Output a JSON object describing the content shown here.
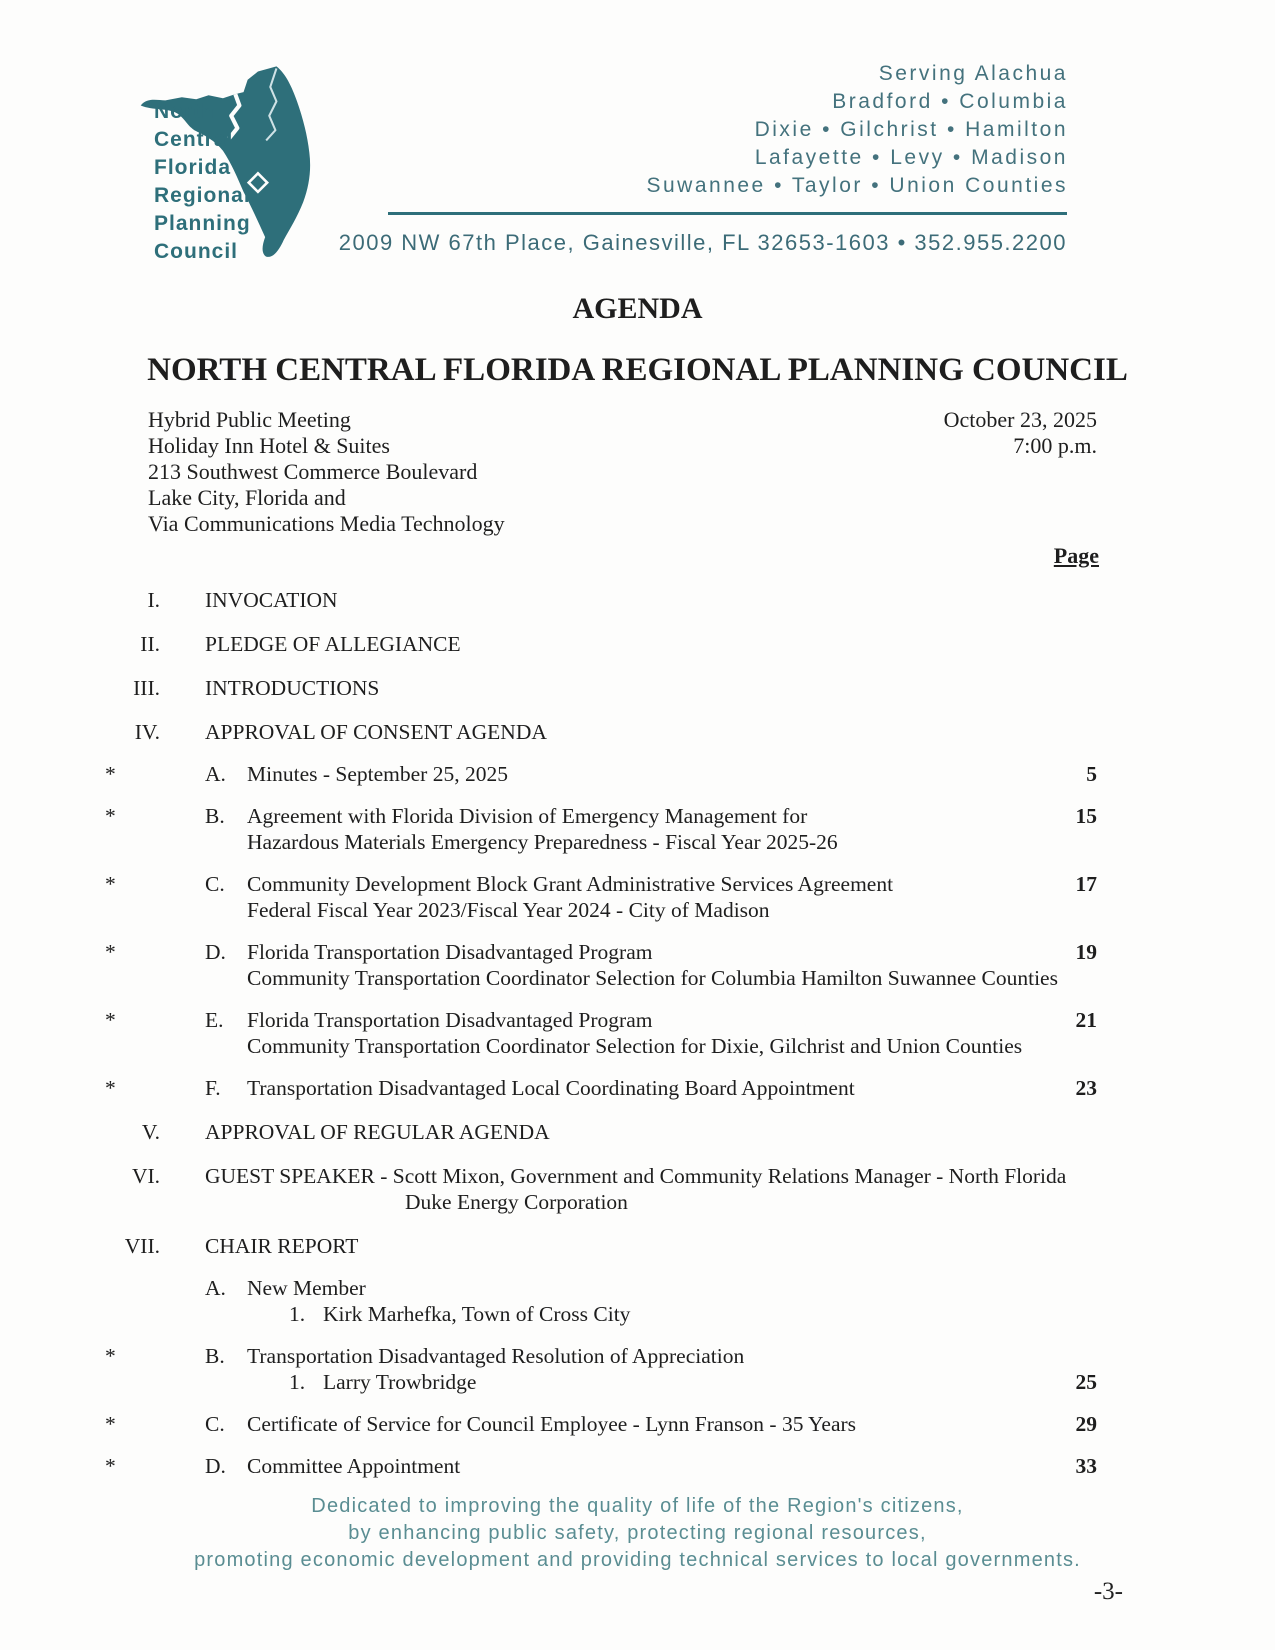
{
  "header": {
    "logo_lines": [
      "North",
      "Central",
      "Florida",
      "Regional",
      "Planning",
      "Council"
    ],
    "serving_lines": [
      "Serving Alachua",
      "Bradford • Columbia",
      "Dixie • Gilchrist • Hamilton",
      "Lafayette • Levy • Madison",
      "Suwannee • Taylor • Union Counties"
    ],
    "address": "2009 NW 67th Place, Gainesville, FL 32653-1603 • 352.955.2200"
  },
  "title": {
    "agenda": "AGENDA",
    "council": "NORTH CENTRAL FLORIDA REGIONAL PLANNING COUNCIL"
  },
  "meeting": {
    "location_lines": [
      "Hybrid Public Meeting",
      "Holiday Inn Hotel & Suites",
      "213 Southwest Commerce Boulevard",
      "Lake City, Florida and",
      "Via Communications Media Technology"
    ],
    "date": "October 23, 2025",
    "time": "7:00 p.m."
  },
  "page_label": "Page",
  "agenda": {
    "items": [
      {
        "num": "I.",
        "title": "INVOCATION"
      },
      {
        "num": "II.",
        "title": "PLEDGE OF ALLEGIANCE"
      },
      {
        "num": "III.",
        "title": "INTRODUCTIONS"
      },
      {
        "num": "IV.",
        "title": "APPROVAL OF CONSENT AGENDA"
      },
      {
        "num": "V.",
        "title": "APPROVAL OF REGULAR AGENDA"
      },
      {
        "num": "VI.",
        "title": "GUEST SPEAKER - Scott Mixon, Government and Community Relations Manager - North Florida",
        "title_line2": "Duke Energy Corporation"
      },
      {
        "num": "VII.",
        "title": "CHAIR REPORT"
      }
    ],
    "consent_items": [
      {
        "star": "*",
        "letter": "A.",
        "line1": "Minutes - September 25, 2025",
        "page": "5"
      },
      {
        "star": "*",
        "letter": "B.",
        "line1": "Agreement with Florida Division of Emergency Management for",
        "line2": "Hazardous Materials Emergency Preparedness - Fiscal Year 2025-26",
        "page": "15"
      },
      {
        "star": "*",
        "letter": "C.",
        "line1": "Community Development Block Grant Administrative Services Agreement",
        "line2": "Federal Fiscal Year 2023/Fiscal Year 2024 - City of Madison",
        "page": "17"
      },
      {
        "star": "*",
        "letter": "D.",
        "line1": "Florida Transportation Disadvantaged Program",
        "line2": "Community Transportation Coordinator Selection for Columbia Hamilton Suwannee Counties",
        "page": "19"
      },
      {
        "star": "*",
        "letter": "E.",
        "line1": "Florida Transportation Disadvantaged Program",
        "line2": "Community Transportation Coordinator Selection for Dixie, Gilchrist and Union Counties",
        "page": "21"
      },
      {
        "star": "*",
        "letter": "F.",
        "line1": "Transportation Disadvantaged Local Coordinating Board Appointment",
        "page": "23"
      }
    ],
    "chair_items": [
      {
        "star": "",
        "letter": "A.",
        "line1": "New Member",
        "num": "1.",
        "num_text": "Kirk Marhefka, Town of Cross City"
      },
      {
        "star": "*",
        "letter": "B.",
        "line1": "Transportation Disadvantaged Resolution of Appreciation",
        "num": "1.",
        "num_text": "Larry Trowbridge",
        "num_page": "25"
      },
      {
        "star": "*",
        "letter": "C.",
        "line1": "Certificate of Service for Council Employee - Lynn Franson - 35 Years",
        "page": "29"
      },
      {
        "star": "*",
        "letter": "D.",
        "line1": "Committee Appointment",
        "page": "33"
      }
    ]
  },
  "footer": {
    "lines": [
      "Dedicated to improving the quality of life of the Region's citizens,",
      "by enhancing public safety, protecting regional resources,",
      "promoting economic development and providing technical services to local governments."
    ],
    "page_number": "-3-"
  },
  "colors": {
    "teal": "#2e6f7a",
    "footer_teal": "#5a8d92",
    "body_text": "#1e1e1e"
  }
}
